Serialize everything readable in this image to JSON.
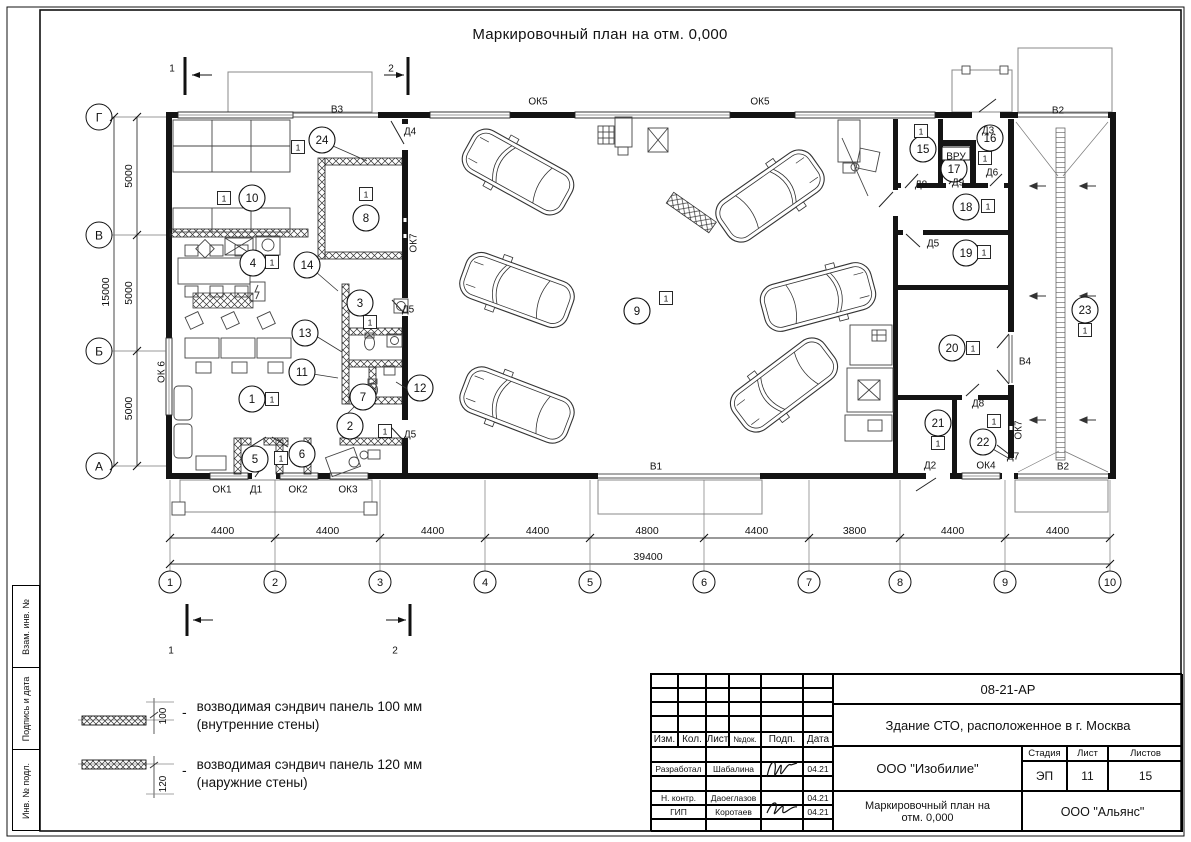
{
  "sheet": {
    "title": "Маркировочный план на отм. 0,000",
    "side_stamp": [
      "Взам. инв. №",
      "Подпись и дата",
      "Инв. № подл."
    ]
  },
  "plan": {
    "badge": "1",
    "grid": {
      "columns": [
        "1",
        "2",
        "3",
        "4",
        "5",
        "6",
        "7",
        "8",
        "9",
        "10"
      ],
      "col_x": [
        170,
        275,
        380,
        485,
        590,
        704,
        809,
        900,
        1005,
        1110
      ],
      "col_spans_mm": [
        "4400",
        "4400",
        "4400",
        "4400",
        "4800",
        "4400",
        "3800",
        "4400",
        "4400"
      ],
      "total_mm": "39400",
      "rows": [
        "Г",
        "В",
        "Б",
        "А"
      ],
      "row_y": [
        117,
        235,
        351,
        466
      ],
      "row_spans_mm": [
        "5000",
        "5000",
        "5000"
      ],
      "row_total_mm": "15000"
    },
    "rooms": [
      {
        "n": "1",
        "x": 252,
        "y": 399,
        "bx": 272,
        "by": 399
      },
      {
        "n": "2",
        "x": 350,
        "y": 426,
        "bx": 385,
        "by": 431
      },
      {
        "n": "3",
        "x": 360,
        "y": 303,
        "bx": 370,
        "by": 322
      },
      {
        "n": "4",
        "x": 253,
        "y": 263,
        "bx": 272,
        "by": 262
      },
      {
        "n": "5",
        "x": 255,
        "y": 459,
        "bx": 281,
        "by": 458
      },
      {
        "n": "6",
        "x": 302,
        "y": 454
      },
      {
        "n": "7",
        "x": 363,
        "y": 397
      },
      {
        "n": "8",
        "x": 366,
        "y": 218,
        "bx": 366,
        "by": 194
      },
      {
        "n": "9",
        "x": 637,
        "y": 311,
        "bx": 666,
        "by": 298
      },
      {
        "n": "10",
        "x": 252,
        "y": 198,
        "bx": 224,
        "by": 198
      },
      {
        "n": "11",
        "x": 302,
        "y": 372
      },
      {
        "n": "12",
        "x": 420,
        "y": 388
      },
      {
        "n": "13",
        "x": 305,
        "y": 333
      },
      {
        "n": "14",
        "x": 307,
        "y": 265
      },
      {
        "n": "15",
        "x": 923,
        "y": 149,
        "bx": 921,
        "by": 131
      },
      {
        "n": "16",
        "x": 990,
        "y": 138,
        "bx": 985,
        "by": 158
      },
      {
        "n": "17",
        "x": 954,
        "y": 169
      },
      {
        "n": "18",
        "x": 966,
        "y": 207,
        "bx": 988,
        "by": 206
      },
      {
        "n": "19",
        "x": 966,
        "y": 253,
        "bx": 984,
        "by": 252
      },
      {
        "n": "20",
        "x": 952,
        "y": 348,
        "bx": 973,
        "by": 348
      },
      {
        "n": "21",
        "x": 938,
        "y": 423,
        "bx": 938,
        "by": 443
      },
      {
        "n": "22",
        "x": 983,
        "y": 442,
        "bx": 994,
        "by": 421
      },
      {
        "n": "23",
        "x": 1085,
        "y": 310,
        "bx": 1085,
        "by": 330
      },
      {
        "n": "24",
        "x": 322,
        "y": 140,
        "bx": 298,
        "by": 147
      }
    ],
    "labels": [
      {
        "t": "ОК5",
        "x": 538,
        "y": 101
      },
      {
        "t": "ОК5",
        "x": 760,
        "y": 101
      },
      {
        "t": "В3",
        "x": 337,
        "y": 109
      },
      {
        "t": "Д4",
        "x": 410,
        "y": 131
      },
      {
        "t": "ОК7",
        "x": 413,
        "y": 243,
        "rot": 1
      },
      {
        "t": "ОК 6",
        "x": 161,
        "y": 372,
        "rot": 1
      },
      {
        "t": "Д5",
        "x": 408,
        "y": 309
      },
      {
        "t": "Д5",
        "x": 410,
        "y": 434
      },
      {
        "t": "ОК1",
        "x": 222,
        "y": 489
      },
      {
        "t": "Д1",
        "x": 256,
        "y": 489
      },
      {
        "t": "ОК2",
        "x": 298,
        "y": 489
      },
      {
        "t": "ОК3",
        "x": 348,
        "y": 489
      },
      {
        "t": "В1",
        "x": 656,
        "y": 466
      },
      {
        "t": "Д2",
        "x": 930,
        "y": 465
      },
      {
        "t": "ОК4",
        "x": 986,
        "y": 465
      },
      {
        "t": "Д7",
        "x": 1013,
        "y": 456
      },
      {
        "t": "В2",
        "x": 1063,
        "y": 466
      },
      {
        "t": "В2",
        "x": 1058,
        "y": 110
      },
      {
        "t": "Д3",
        "x": 988,
        "y": 130
      },
      {
        "t": "Д8",
        "x": 921,
        "y": 184
      },
      {
        "t": "Д9",
        "x": 958,
        "y": 182
      },
      {
        "t": "Д6",
        "x": 992,
        "y": 172
      },
      {
        "t": "ВРУ",
        "x": 956,
        "y": 156,
        "box": 1
      },
      {
        "t": "Д5",
        "x": 933,
        "y": 243
      },
      {
        "t": "Д8",
        "x": 978,
        "y": 403
      },
      {
        "t": "ОК7",
        "x": 1018,
        "y": 430,
        "rot": 1
      },
      {
        "t": "В4",
        "x": 1025,
        "y": 361
      },
      {
        "t": "1",
        "x": 172,
        "y": 68
      },
      {
        "t": "2",
        "x": 391,
        "y": 68
      },
      {
        "t": "1",
        "x": 171,
        "y": 650
      },
      {
        "t": "2",
        "x": 395,
        "y": 650
      }
    ]
  },
  "legend": {
    "items": [
      {
        "dim": "100",
        "line1": "возводимая сэндвич панель 100 мм",
        "line2": "(внутренние стены)"
      },
      {
        "dim": "120",
        "line1": "возводимая сэндвич панель 120 мм",
        "line2": "(наружние стены)"
      }
    ]
  },
  "title_block": {
    "doc_number": "08-21-АР",
    "project": "Здание СТО, расположенное в г. Москва",
    "columns": [
      "Изм.",
      "Кол.",
      "Лист",
      "№док.",
      "Подп.",
      "Дата"
    ],
    "rows": [
      {
        "role": "Разработал",
        "name": "Шабалина",
        "date": "04.21"
      },
      {
        "role": "Н. контр.",
        "name": "Даоеглазов",
        "date": "04.21"
      },
      {
        "role": "ГИП",
        "name": "Коротаев",
        "date": "04.21"
      }
    ],
    "org1": "ООО \"Изобилие\"",
    "stage_label": "Стадия",
    "sheet_label": "Лист",
    "sheets_label": "Листов",
    "stage": "ЭП",
    "sheet": "11",
    "sheets": "15",
    "drawing_name1": "Маркировочный план на",
    "drawing_name2": "отм. 0,000",
    "org2": "ООО \"Альянс\""
  }
}
